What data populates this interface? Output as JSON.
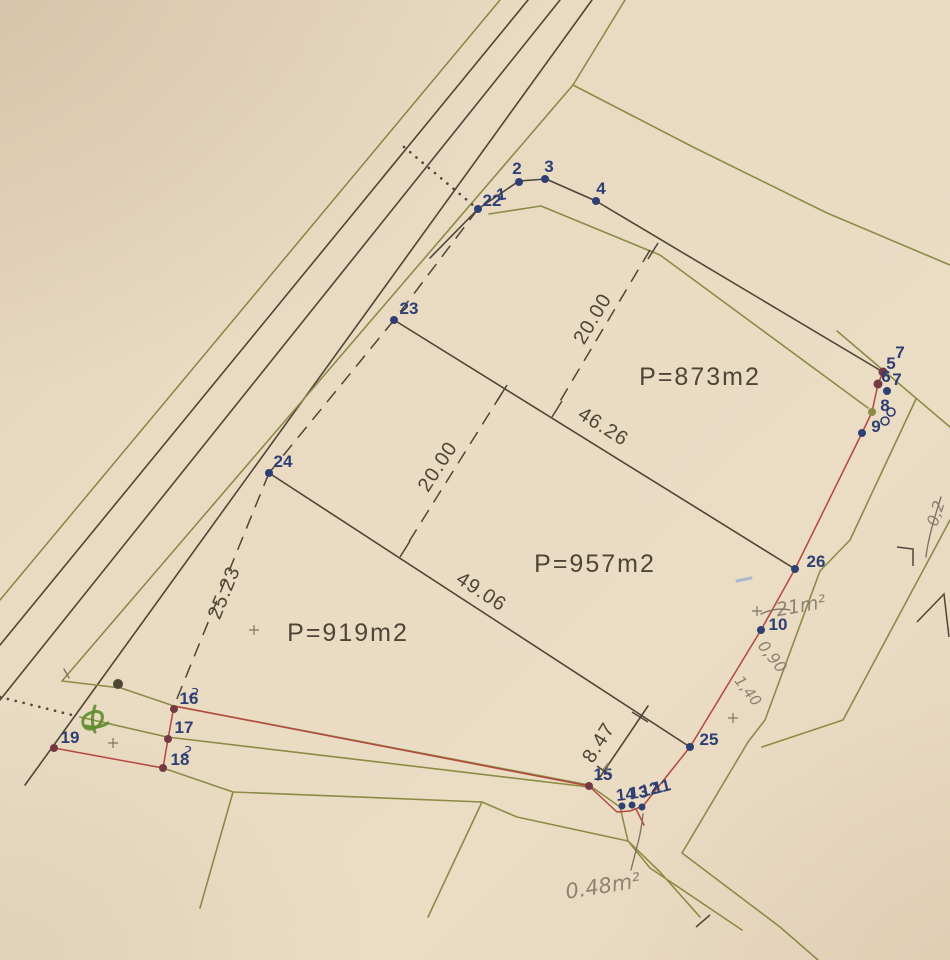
{
  "document": {
    "kind": "scanned cadastral parcel sketch",
    "parcel_areas": [
      "P=873m2",
      "P=957m2",
      "P=919m2"
    ],
    "measurements": [
      "20.00",
      "20.00",
      "46.26",
      "49.06",
      "25.23",
      "8.47"
    ],
    "survey_point_numbers": [
      "1",
      "2",
      "3",
      "4",
      "5",
      "6",
      "7",
      "8",
      "9",
      "10",
      "11",
      "12",
      "13",
      "14",
      "15",
      "16",
      "17",
      "18",
      "19",
      "22",
      "23",
      "24",
      "25",
      "26"
    ]
  },
  "diagram": {
    "width": 950,
    "height": 960,
    "colors": {
      "paper": "#e9dac2",
      "ink": "#4e4537",
      "olive": "#8b8c44",
      "red": "#b5473e",
      "navy": "#2e3f74",
      "maroon": "#743a44",
      "pencil": "#7e7466",
      "green_pen": "#5f8c2d",
      "blue_pen": "#8aa4cf"
    },
    "area_labels": [
      {
        "text": "P=873m2",
        "x": 700,
        "y": 385
      },
      {
        "text": "P=957m2",
        "x": 595,
        "y": 572
      },
      {
        "text": "P=919m2",
        "x": 348,
        "y": 641
      }
    ],
    "dimensions": [
      {
        "text": "20.00",
        "x": 598,
        "y": 322,
        "rot": -59
      },
      {
        "text": "20.00",
        "x": 443,
        "y": 470,
        "rot": -57
      },
      {
        "text": "46.26",
        "x": 600,
        "y": 432,
        "rot": 32
      },
      {
        "text": "49.06",
        "x": 478,
        "y": 597,
        "rot": 33
      },
      {
        "text": "25.23",
        "x": 230,
        "y": 595,
        "rot": -68
      },
      {
        "text": "8.47",
        "x": 604,
        "y": 746,
        "rot": -58
      }
    ],
    "point_labels": [
      {
        "text": "22",
        "x": 492,
        "y": 206,
        "rot": 0
      },
      {
        "text": "1",
        "x": 502,
        "y": 200,
        "rot": -8
      },
      {
        "text": "2",
        "x": 517,
        "y": 174,
        "rot": 0
      },
      {
        "text": "3",
        "x": 549,
        "y": 172,
        "rot": 0
      },
      {
        "text": "4",
        "x": 601,
        "y": 194,
        "rot": 0
      },
      {
        "text": "7",
        "x": 900,
        "y": 358,
        "rot": 0
      },
      {
        "text": "5",
        "x": 891,
        "y": 369,
        "rot": 0
      },
      {
        "text": "6",
        "x": 886,
        "y": 382,
        "rot": 0
      },
      {
        "text": "7",
        "x": 897,
        "y": 385,
        "rot": 0
      },
      {
        "text": "8",
        "x": 885,
        "y": 411,
        "rot": 0
      },
      {
        "text": "9",
        "x": 876,
        "y": 432,
        "rot": 0
      },
      {
        "text": "26",
        "x": 816,
        "y": 567,
        "rot": 0
      },
      {
        "text": "10",
        "x": 778,
        "y": 630,
        "rot": 0
      },
      {
        "text": "25",
        "x": 709,
        "y": 745,
        "rot": 0
      },
      {
        "text": "23",
        "x": 409,
        "y": 314,
        "rot": 0
      },
      {
        "text": "24",
        "x": 283,
        "y": 467,
        "rot": 0
      },
      {
        "text": "16",
        "x": 189,
        "y": 704,
        "rot": 0
      },
      {
        "text": "17",
        "x": 184,
        "y": 733,
        "rot": 0
      },
      {
        "text": "18",
        "x": 180,
        "y": 765,
        "rot": 0
      },
      {
        "text": "19",
        "x": 70,
        "y": 743,
        "rot": 0
      },
      {
        "text": "15",
        "x": 603,
        "y": 780,
        "rot": 0
      },
      {
        "text": "14",
        "x": 626,
        "y": 800,
        "rot": -6
      },
      {
        "text": "13",
        "x": 639,
        "y": 798,
        "rot": -6
      },
      {
        "text": "12",
        "x": 651,
        "y": 795,
        "rot": -14
      },
      {
        "text": "11",
        "x": 663,
        "y": 792,
        "rot": -14
      }
    ],
    "dots": [
      {
        "x": 519,
        "y": 182,
        "c": "navy",
        "r": 4
      },
      {
        "x": 545,
        "y": 179,
        "c": "navy",
        "r": 4
      },
      {
        "x": 596,
        "y": 201,
        "c": "navy",
        "r": 4
      },
      {
        "x": 478,
        "y": 209,
        "c": "navy",
        "r": 4
      },
      {
        "x": 394,
        "y": 320,
        "c": "navy",
        "r": 4
      },
      {
        "x": 269,
        "y": 473,
        "c": "navy",
        "r": 4
      },
      {
        "x": 795,
        "y": 569,
        "c": "navy",
        "r": 4
      },
      {
        "x": 761,
        "y": 630,
        "c": "navy",
        "r": 4
      },
      {
        "x": 690,
        "y": 747,
        "c": "navy",
        "r": 4
      },
      {
        "x": 862,
        "y": 433,
        "c": "navy",
        "r": 4
      },
      {
        "x": 887,
        "y": 391,
        "c": "navy",
        "r": 4
      },
      {
        "x": 622,
        "y": 806,
        "c": "navy",
        "r": 3.5
      },
      {
        "x": 632,
        "y": 805,
        "c": "navy",
        "r": 3.5
      },
      {
        "x": 642,
        "y": 807,
        "c": "navy",
        "r": 3.5
      },
      {
        "x": 589,
        "y": 786,
        "c": "maroon",
        "r": 4
      },
      {
        "x": 174,
        "y": 709,
        "c": "maroon",
        "r": 4
      },
      {
        "x": 168,
        "y": 739,
        "c": "maroon",
        "r": 4
      },
      {
        "x": 163,
        "y": 768,
        "c": "maroon",
        "r": 4
      },
      {
        "x": 54,
        "y": 748,
        "c": "maroon",
        "r": 4
      },
      {
        "x": 883,
        "y": 372,
        "c": "maroon",
        "r": 4.5
      },
      {
        "x": 878,
        "y": 384,
        "c": "maroon",
        "r": 4.5
      },
      {
        "x": 872,
        "y": 412,
        "c": "olive",
        "r": 4
      },
      {
        "x": 118,
        "y": 684,
        "c": "ink",
        "r": 5
      }
    ],
    "circles": [
      {
        "x": 891,
        "y": 412,
        "r": 4
      },
      {
        "x": 885,
        "y": 421,
        "r": 4
      }
    ],
    "lines": [
      {
        "c": "olive",
        "pts": [
          [
            500,
            0
          ],
          [
            0,
            600
          ]
        ]
      },
      {
        "c": "ink",
        "pts": [
          [
            528,
            0
          ],
          [
            0,
            645
          ]
        ]
      },
      {
        "c": "ink",
        "pts": [
          [
            560,
            0
          ],
          [
            0,
            700
          ]
        ]
      },
      {
        "c": "ink",
        "pts": [
          [
            592,
            0
          ],
          [
            25,
            785
          ]
        ]
      },
      {
        "c": "olive",
        "pts": [
          [
            625,
            0
          ],
          [
            573,
            85
          ],
          [
            62,
            681
          ],
          [
            121,
            688
          ],
          [
            174,
            706
          ],
          [
            589,
            785
          ],
          [
            620,
            807
          ],
          [
            628,
            841
          ],
          [
            660,
            872
          ],
          [
            700,
            917
          ]
        ]
      },
      {
        "c": "olive",
        "pts": [
          [
            573,
            85
          ],
          [
            693,
            147
          ],
          [
            827,
            213
          ],
          [
            950,
            265
          ]
        ]
      },
      {
        "c": "olive",
        "pts": [
          [
            80,
            717
          ],
          [
            167,
            737
          ],
          [
            589,
            787
          ]
        ]
      },
      {
        "c": "olive",
        "pts": [
          [
            163,
            768
          ],
          [
            233,
            792
          ],
          [
            482,
            802
          ],
          [
            517,
            817
          ],
          [
            628,
            841
          ],
          [
            650,
            868
          ],
          [
            742,
            930
          ]
        ]
      },
      {
        "c": "olive",
        "pts": [
          [
            233,
            792
          ],
          [
            200,
            908
          ]
        ]
      },
      {
        "c": "olive",
        "pts": [
          [
            482,
            802
          ],
          [
            428,
            917
          ]
        ]
      },
      {
        "c": "olive",
        "pts": [
          [
            489,
            214
          ],
          [
            541,
            206
          ],
          [
            660,
            255
          ],
          [
            868,
            408
          ]
        ]
      },
      {
        "c": "olive",
        "pts": [
          [
            837,
            331
          ],
          [
            950,
            427
          ]
        ]
      },
      {
        "c": "olive",
        "pts": [
          [
            916,
            399
          ],
          [
            850,
            540
          ],
          [
            820,
            571
          ],
          [
            765,
            720
          ],
          [
            748,
            742
          ],
          [
            682,
            853
          ],
          [
            780,
            927
          ],
          [
            818,
            960
          ]
        ]
      },
      {
        "c": "olive",
        "pts": [
          [
            950,
            520
          ],
          [
            843,
            720
          ],
          [
            762,
            747
          ]
        ]
      },
      {
        "c": "ink",
        "pts": [
          [
            430,
            258
          ],
          [
            478,
            209
          ],
          [
            519,
            181
          ],
          [
            546,
            179
          ],
          [
            596,
            201
          ],
          [
            883,
            372
          ]
        ]
      },
      {
        "c": "ink",
        "pts": [
          [
            394,
            320
          ],
          [
            795,
            569
          ]
        ]
      },
      {
        "c": "ink",
        "pts": [
          [
            269,
            473
          ],
          [
            690,
            747
          ]
        ]
      },
      {
        "c": "ink",
        "pts": [
          [
            648,
            706
          ],
          [
            598,
            780
          ]
        ]
      },
      {
        "c": "red",
        "pts": [
          [
            883,
            372
          ],
          [
            878,
            384
          ],
          [
            872,
            412
          ],
          [
            862,
            433
          ],
          [
            795,
            569
          ],
          [
            761,
            630
          ],
          [
            690,
            747
          ],
          [
            643,
            806
          ],
          [
            630,
            811
          ],
          [
            617,
            812
          ],
          [
            589,
            786
          ],
          [
            174,
            706
          ]
        ]
      },
      {
        "c": "red",
        "pts": [
          [
            174,
            706
          ],
          [
            168,
            739
          ],
          [
            163,
            768
          ],
          [
            54,
            748
          ]
        ]
      },
      {
        "c": "red",
        "pts": [
          [
            636,
            809
          ],
          [
            644,
            825
          ]
        ]
      }
    ],
    "dashed_lines": [
      {
        "pts": [
          [
            478,
            209
          ],
          [
            394,
            320
          ]
        ]
      },
      {
        "pts": [
          [
            394,
            320
          ],
          [
            269,
            473
          ]
        ]
      },
      {
        "pts": [
          [
            269,
            473
          ],
          [
            174,
            706
          ]
        ]
      },
      {
        "pts": [
          [
            650,
            250
          ],
          [
            556,
            408
          ]
        ]
      },
      {
        "pts": [
          [
            502,
            393
          ],
          [
            405,
            548
          ]
        ]
      }
    ],
    "dotted_lines": [
      {
        "pts": [
          [
            404,
            147
          ],
          [
            474,
            206
          ]
        ]
      },
      {
        "pts": [
          [
            0,
            697
          ],
          [
            76,
            716
          ]
        ]
      }
    ],
    "ticks": [
      [
        [
          648,
          259
        ],
        [
          658,
          243
        ]
      ],
      [
        [
          552,
          417
        ],
        [
          562,
          401
        ]
      ],
      [
        [
          497,
          401
        ],
        [
          507,
          385
        ]
      ],
      [
        [
          400,
          557
        ],
        [
          410,
          541
        ]
      ],
      [
        [
          632,
          712
        ],
        [
          648,
          722
        ]
      ],
      [
        [
          597,
          766
        ],
        [
          611,
          776
        ]
      ],
      [
        [
          696,
          927
        ],
        [
          710,
          915
        ]
      ]
    ],
    "crosses": [
      {
        "x": 113,
        "y": 743
      },
      {
        "x": 733,
        "y": 718
      },
      {
        "x": 757,
        "y": 611
      },
      {
        "x": 254,
        "y": 630
      }
    ],
    "handwritten": [
      {
        "text": "21m²",
        "x": 802,
        "y": 612,
        "rot": -10,
        "size": 19,
        "c": "pencil"
      },
      {
        "text": "0,90",
        "x": 768,
        "y": 660,
        "rot": 52,
        "size": 16,
        "c": "pencil"
      },
      {
        "text": "1,40",
        "x": 744,
        "y": 694,
        "rot": 52,
        "size": 15,
        "c": "pencil"
      },
      {
        "text": "0.48m²",
        "x": 604,
        "y": 893,
        "rot": -9,
        "size": 21,
        "c": "pencil"
      },
      {
        "text": "0,2",
        "x": 941,
        "y": 515,
        "rot": -72,
        "size": 16,
        "c": "pencil"
      },
      {
        "text": "4",
        "x": 606,
        "y": 772,
        "rot": 0,
        "size": 12,
        "c": "pencil"
      },
      {
        "text": "2",
        "x": 193,
        "y": 698,
        "rot": 12,
        "size": 14,
        "c": "navy"
      },
      {
        "text": "2",
        "x": 186,
        "y": 756,
        "rot": 12,
        "size": 14,
        "c": "navy"
      }
    ],
    "pencil_paths": [
      "M761,614 Q776,607 790,610",
      "M643,814 C641,836 635,853 631,870",
      "M941,497 C934,519 928,539 926,557",
      "M64,669 l5,9"
    ],
    "ink_marks": [
      "M897,547 L913,549 L913,566",
      "M917,622 L944,594 L949,637"
    ],
    "green_scribble": [
      "M88,714 c10,-5 16,-2 14,6 c-3,9 -14,12 -18,6 c-3,-5 0,-10 4,-12",
      "M95,706 c-3,9 -4,18 0,26",
      "M86,726 c8,2 16,1 22,-3"
    ],
    "blue_mark": "M737,581 L751,578"
  }
}
